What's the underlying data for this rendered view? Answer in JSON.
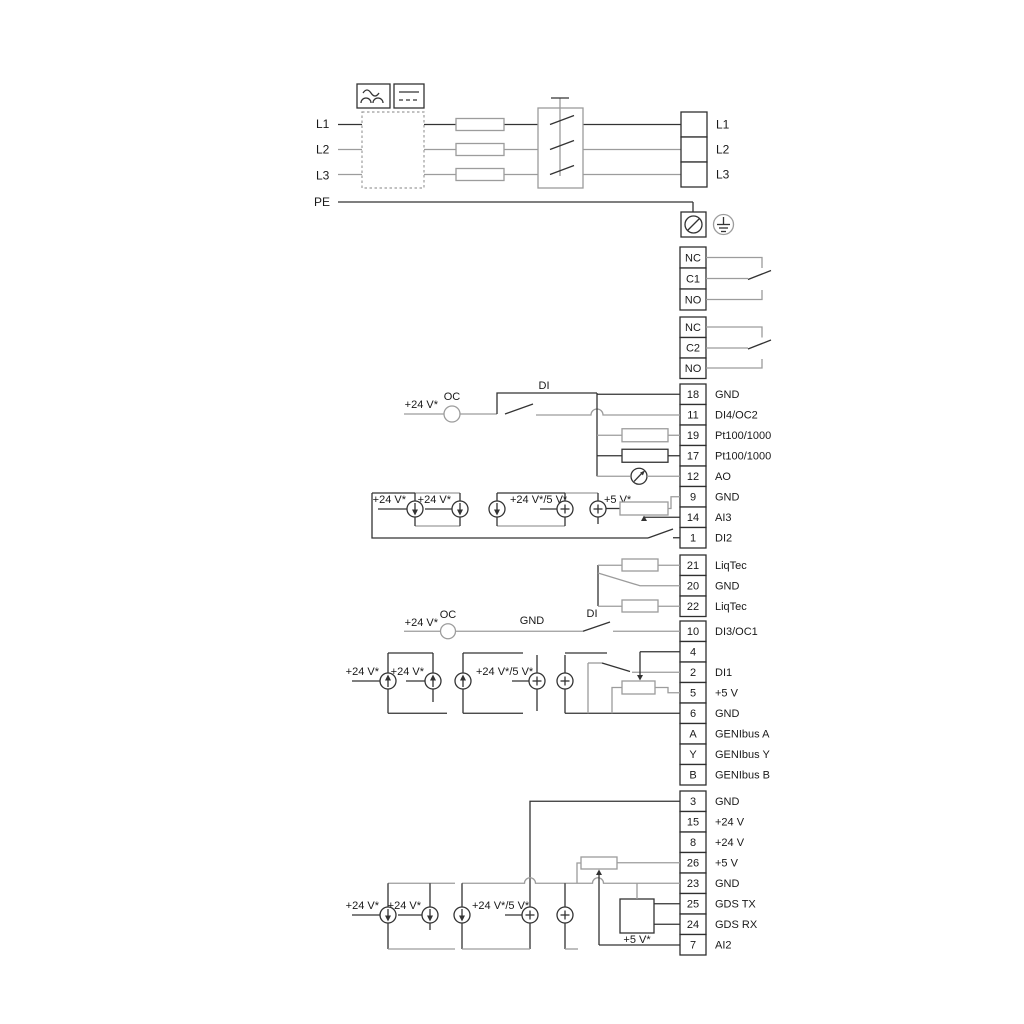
{
  "labels": {
    "v24": "+24 V*",
    "v24_5": "+24 V*/5 V*",
    "v5": "+5 V*",
    "oc": "OC",
    "di": "DI",
    "gnd": "GND"
  },
  "power": {
    "inputs": [
      "L1",
      "L2",
      "L3",
      "PE"
    ],
    "outputs": [
      "L1",
      "L2",
      "L3"
    ]
  },
  "relays": {
    "relay1": [
      "NC",
      "C1",
      "NO"
    ],
    "relay2": [
      "NC",
      "C2",
      "NO"
    ]
  },
  "strip1": [
    {
      "num": "18",
      "label": "GND"
    },
    {
      "num": "11",
      "label": "DI4/OC2"
    },
    {
      "num": "19",
      "label": "Pt100/1000"
    },
    {
      "num": "17",
      "label": "Pt100/1000"
    },
    {
      "num": "12",
      "label": "AO"
    },
    {
      "num": "9",
      "label": "GND"
    },
    {
      "num": "14",
      "label": "AI3"
    },
    {
      "num": "1",
      "label": "DI2"
    }
  ],
  "liqtec": [
    {
      "num": "21",
      "label": "LiqTec"
    },
    {
      "num": "20",
      "label": "GND"
    },
    {
      "num": "22",
      "label": "LiqTec"
    }
  ],
  "strip2": [
    {
      "num": "10",
      "label": "DI3/OC1"
    },
    {
      "num": "4",
      "label": "AI1"
    },
    {
      "num": "2",
      "label": "DI1"
    },
    {
      "num": "5",
      "label": "+5 V"
    },
    {
      "num": "6",
      "label": "GND"
    },
    {
      "num": "A",
      "label": "GENIbus A"
    },
    {
      "num": "Y",
      "label": "GENIbus Y"
    },
    {
      "num": "B",
      "label": "GENIbus B"
    }
  ],
  "strip3": [
    {
      "num": "3",
      "label": "GND"
    },
    {
      "num": "15",
      "label": "+24 V"
    },
    {
      "num": "8",
      "label": "+24 V"
    },
    {
      "num": "26",
      "label": "+5 V"
    },
    {
      "num": "23",
      "label": "GND"
    },
    {
      "num": "25",
      "label": "GDS TX"
    },
    {
      "num": "24",
      "label": "GDS RX"
    },
    {
      "num": "7",
      "label": "AI2"
    }
  ]
}
